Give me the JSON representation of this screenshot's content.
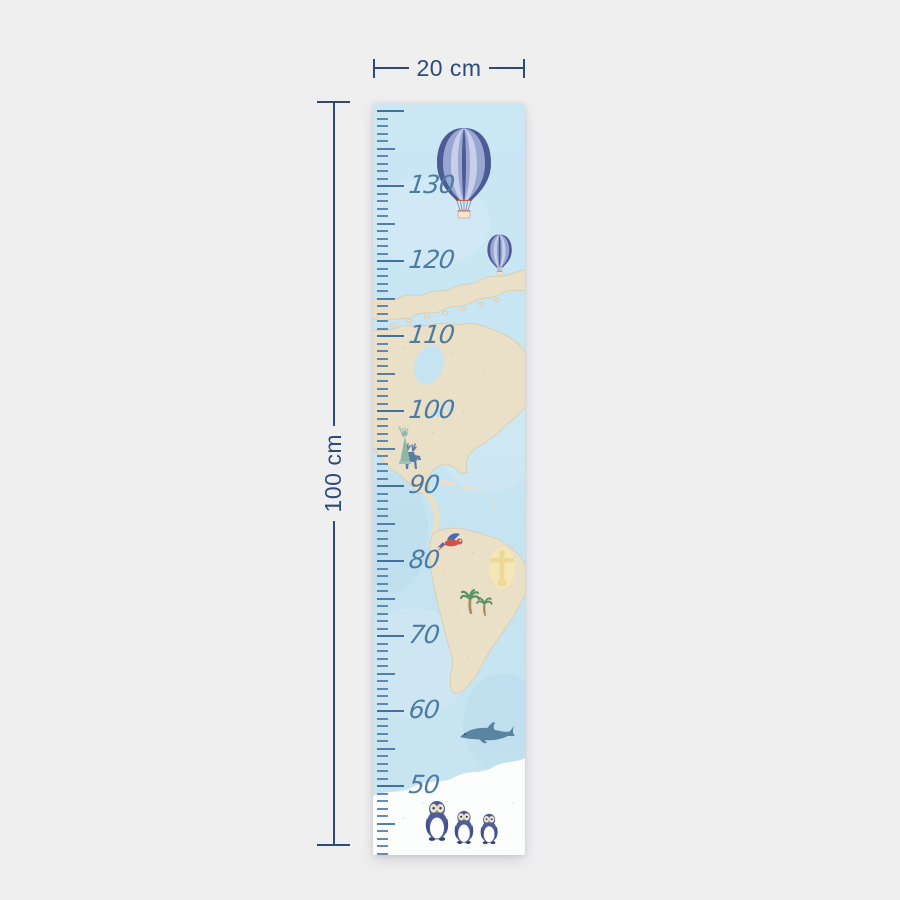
{
  "product": {
    "name": "kids world-map growth chart ruler",
    "background_color": "#f0eff0"
  },
  "dimensions": {
    "width_label": "20 cm",
    "height_label": "100 cm",
    "annotation_color": "#2e4a7a"
  },
  "ruler": {
    "min_cm": 41,
    "max_cm": 140,
    "px_per_cm": 7.5,
    "top_offset_px": 7,
    "labeled_marks": [
      130,
      120,
      110,
      100,
      90,
      80,
      70,
      60,
      50
    ],
    "tick_color": "#4a79a6",
    "label_color": "#4d7ba3"
  },
  "poster": {
    "sky_color": "#c6e3f1",
    "land_color": "#eadfc7",
    "snow_color": "#fcfdfd",
    "elements": [
      {
        "name": "hot-air-balloon-large",
        "colors": [
          "#4d5a94",
          "#98a6d2",
          "#c6d0ea",
          "#f1e6d0"
        ]
      },
      {
        "name": "hot-air-balloon-small",
        "colors": [
          "#4d5a94",
          "#98a6d2",
          "#c6d0ea",
          "#f1e6d0"
        ]
      },
      {
        "name": "moose",
        "color": "#5b7ca3"
      },
      {
        "name": "statue-of-liberty",
        "color": "#8fb7a6"
      },
      {
        "name": "macaw-parrot",
        "colors": [
          "#cf5348",
          "#4a6cb0"
        ]
      },
      {
        "name": "christ-the-redeemer",
        "color": "#edd896"
      },
      {
        "name": "palm-trees",
        "colors": [
          "#5d9166",
          "#a68d62"
        ]
      },
      {
        "name": "dolphin",
        "color": "#5b84a2"
      },
      {
        "name": "penguins",
        "count": 3,
        "colors": [
          "#505c99",
          "#ffffff",
          "#e9e2c8"
        ]
      }
    ]
  }
}
